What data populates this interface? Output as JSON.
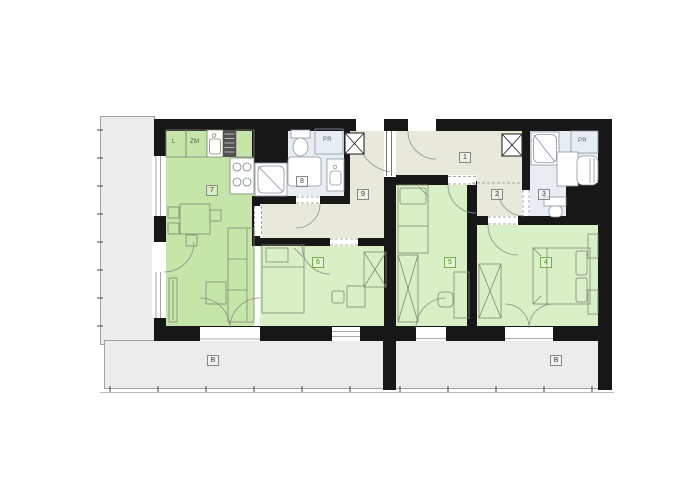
{
  "colors": {
    "wall": "#171717",
    "living_green": "#c5e6a8",
    "bedroom_green": "#d9efc5",
    "hall_beige": "#e8e9da",
    "bath_blue": "#e8edf4",
    "outdoor_gray": "#ececec",
    "line": "#8f8f8f",
    "furn": "#7d8876",
    "fix": "#8d96a0",
    "label_gray_border": "#878787",
    "label_gray_text": "#3a3a3a",
    "label_green_border": "#74ae45",
    "label_green_text": "#4c8c20"
  },
  "rooms": {
    "r1": {
      "label": "1"
    },
    "r2": {
      "label": "2"
    },
    "r3": {
      "label": "3"
    },
    "r4": {
      "label": "4"
    },
    "r5": {
      "label": "5"
    },
    "r6": {
      "label": "6"
    },
    "r7": {
      "label": "7"
    },
    "r8": {
      "label": "8"
    },
    "r9": {
      "label": "9"
    }
  },
  "outdoor": {
    "terrace_left_label": "B",
    "terrace_right_label": "B"
  },
  "kitchen": {
    "cabinet_left": "L",
    "cabinet_right": "ZM"
  },
  "closets": {
    "bath8": "PR",
    "bath3": "PR"
  }
}
